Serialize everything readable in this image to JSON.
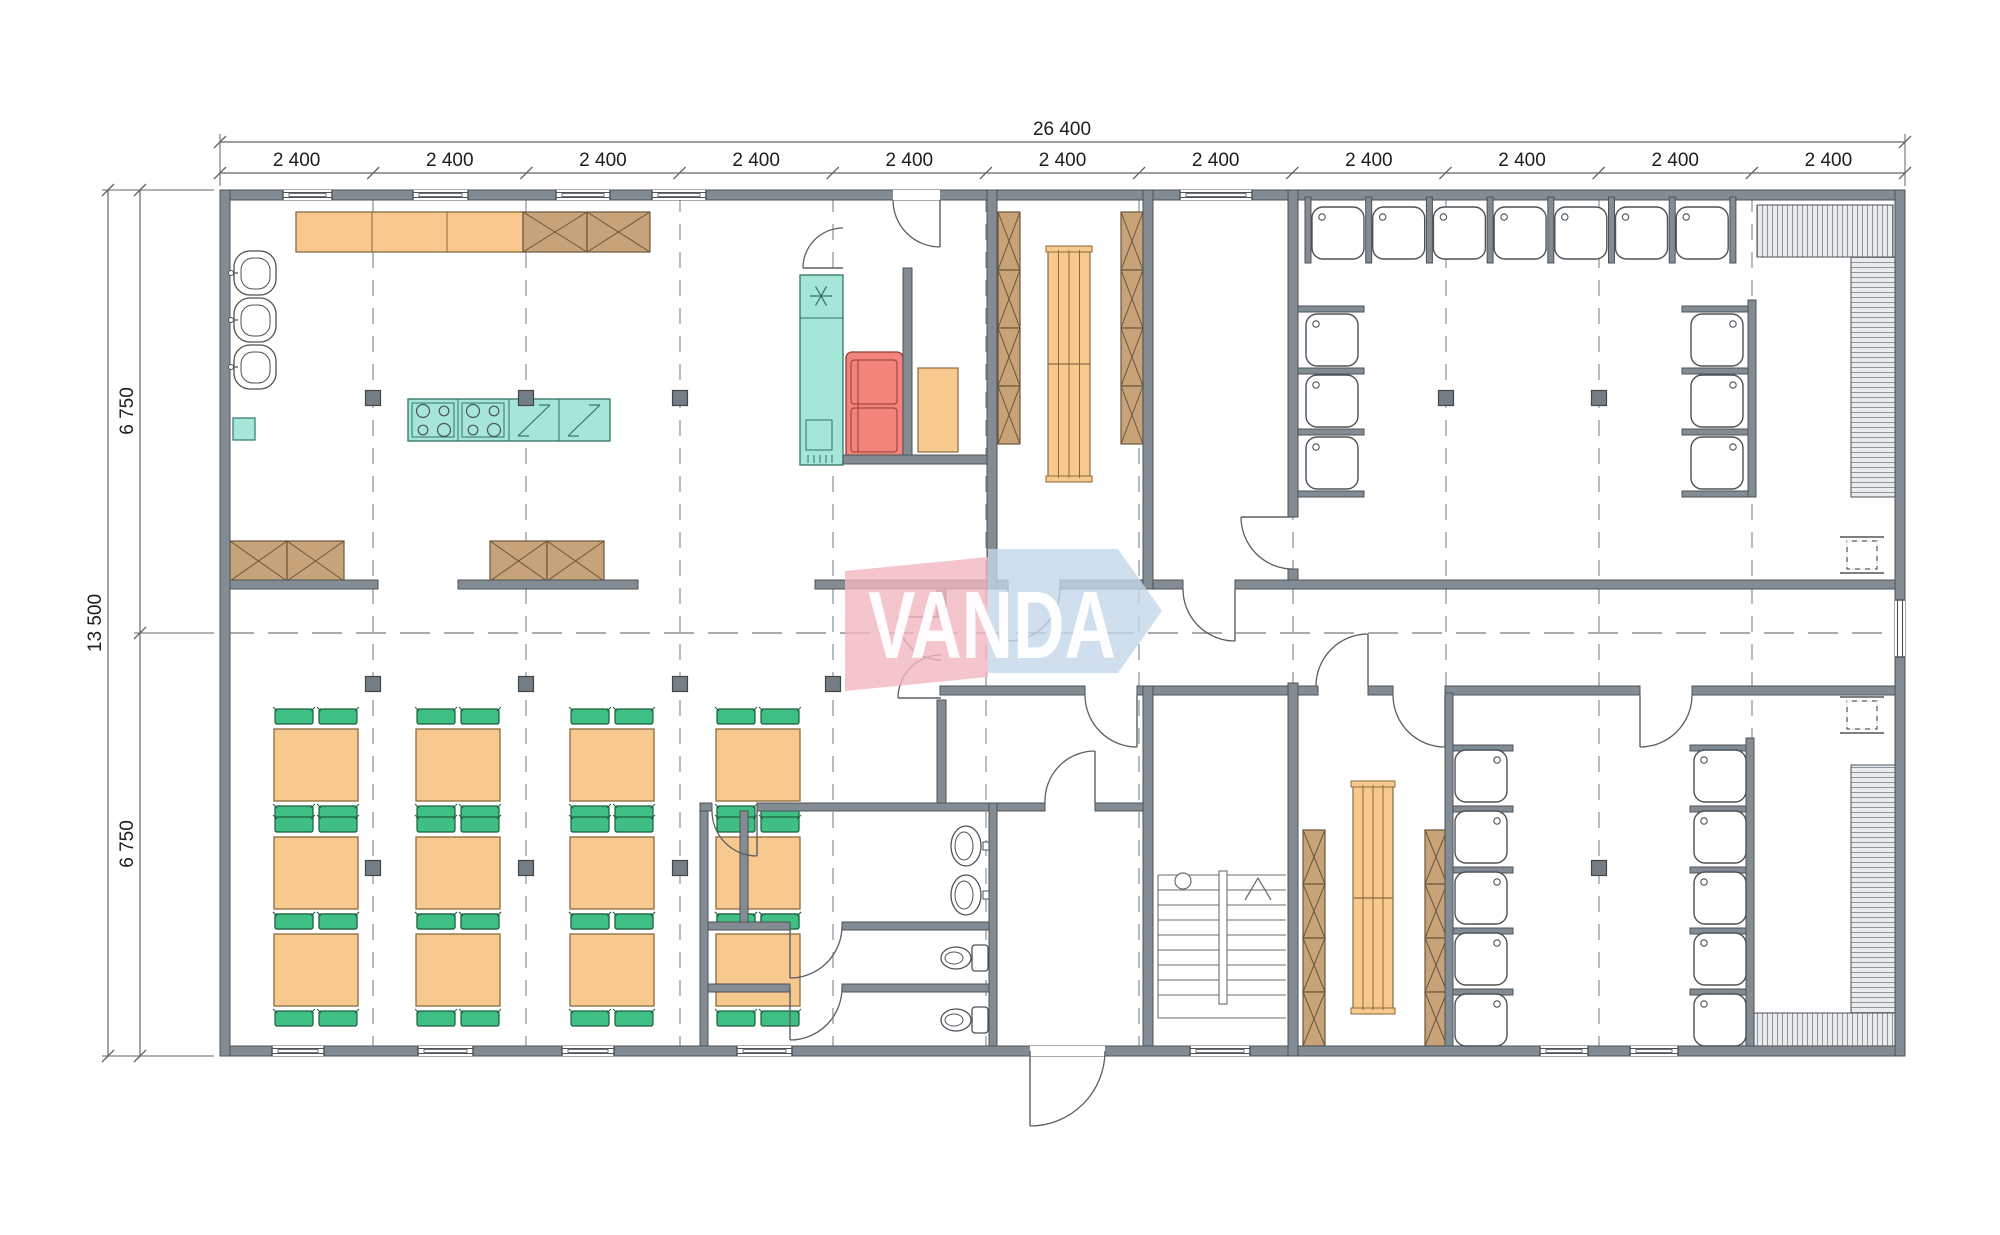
{
  "watermark": {
    "text": "VANDA",
    "pink": "#f2b6c1",
    "blue": "#c3d7ea",
    "letter_color": "#ffffff"
  },
  "dimensions": {
    "top_total": "26 400",
    "top_segments": [
      "2 400",
      "2 400",
      "2 400",
      "2 400",
      "2 400",
      "2 400",
      "2 400",
      "2 400",
      "2 400",
      "2 400",
      "2 400"
    ],
    "left_total": "13 500",
    "left_segments": [
      "6 750",
      "6 750"
    ]
  },
  "colors": {
    "wall": "#848c93",
    "wall_stroke": "#4c5257",
    "dim_line": "#60666b",
    "text": "#1d1d1f",
    "axis": "#8a9096",
    "furniture_orange": "#f8c98e",
    "furniture_orange_stroke": "#8a6a3c",
    "cabinet_brown": "#c7a379",
    "cabinet_brown_stroke": "#6d5639",
    "appliance_teal": "#a5e6d9",
    "appliance_teal_stroke": "#2f7466",
    "appliance_red": "#f2847b",
    "appliance_red_stroke": "#8f3b35",
    "chair_green": "#40bf84",
    "chair_green_stroke": "#1c5e3d",
    "fixture_stroke": "#4c5257",
    "hatch_bg": "#e9ebed",
    "hatch_line": "#8f969b",
    "column": "#767e85"
  }
}
